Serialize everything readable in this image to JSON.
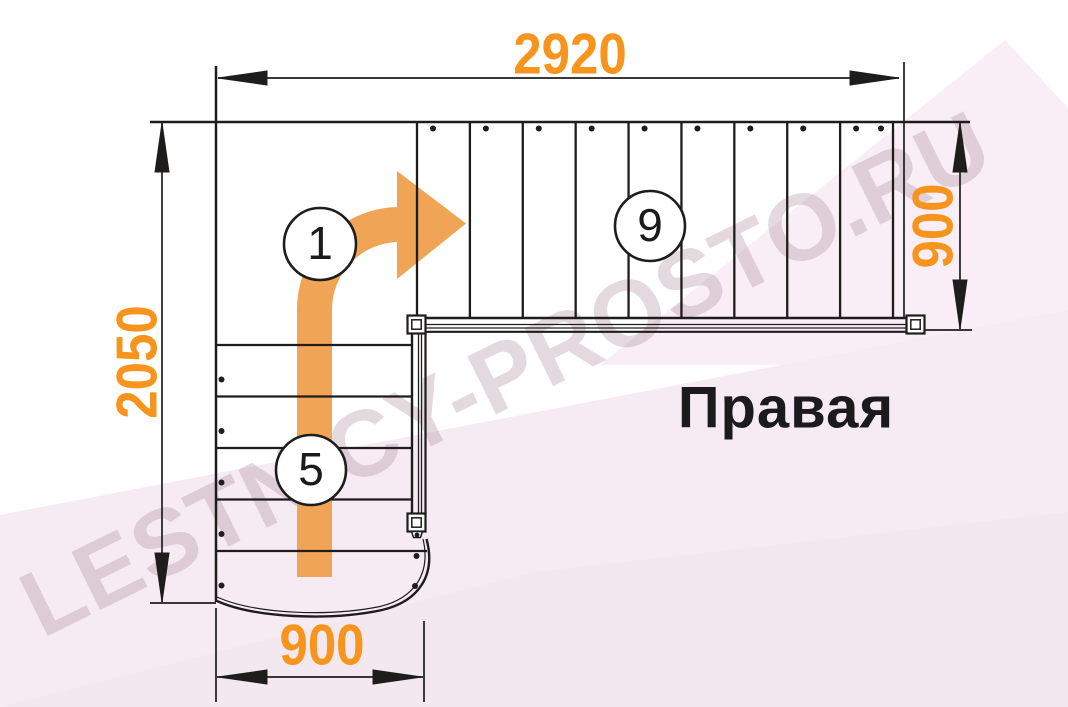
{
  "diagram": {
    "side_label": "Правая",
    "watermark": "LESTNICY-PROSTO.RU",
    "dimensions": {
      "top": "2920",
      "left": "2050",
      "right": "900",
      "bottom": "900"
    },
    "flights": {
      "start_step_label": "1",
      "lower": {
        "label": "5",
        "steps": 5
      },
      "upper": {
        "label": "9",
        "steps": 9
      }
    },
    "colors": {
      "dimension_text": "#f6941e",
      "direction_arrow": "#f0a455",
      "line": "#1e1d1b",
      "background_tint_light": "#f9eef5",
      "background_tint": "#f7ebf3",
      "background_tint_dark": "#f2e6ee"
    }
  }
}
